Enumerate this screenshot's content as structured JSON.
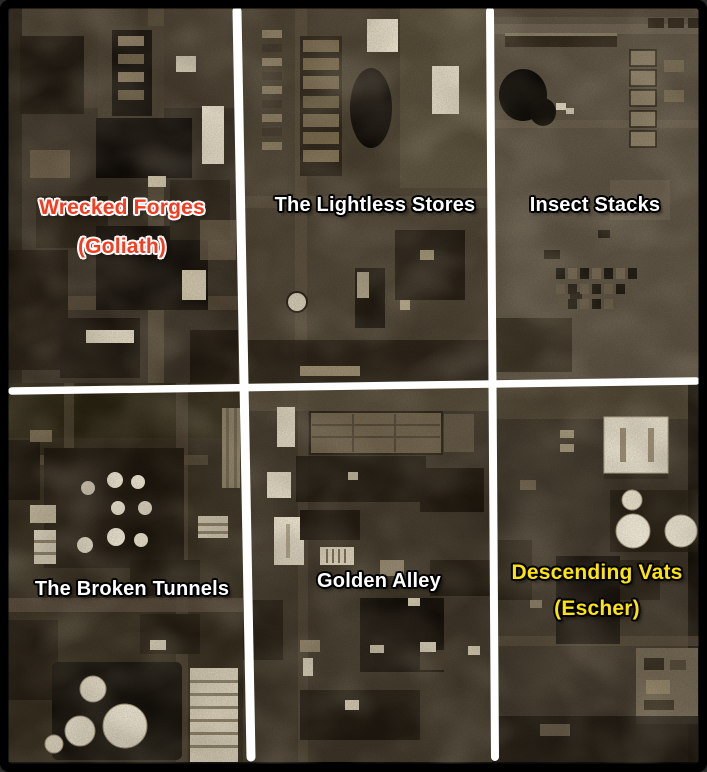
{
  "map": {
    "sectors": [
      {
        "name": "Wrecked Forges",
        "subtitle": "(Goliath)",
        "label_color": "#fa3a1e",
        "outline_color": "#ffffff"
      },
      {
        "name": "The Lightless Stores",
        "subtitle": "",
        "label_color": "#ffffff",
        "outline_color": "#000000"
      },
      {
        "name": "Insect Stacks",
        "subtitle": "",
        "label_color": "#ffffff",
        "outline_color": "#000000"
      },
      {
        "name": "The Broken Tunnels",
        "subtitle": "",
        "label_color": "#ffffff",
        "outline_color": "#000000"
      },
      {
        "name": "Golden Alley",
        "subtitle": "",
        "label_color": "#ffffff",
        "outline_color": "#000000"
      },
      {
        "name": "Descending Vats",
        "subtitle": "(Escher)",
        "label_color": "#ffe409",
        "outline_color": "#000000"
      }
    ],
    "divider_color": "#ffffff",
    "border_color": "#000000",
    "grid": {
      "rows": 2,
      "columns": 3
    }
  }
}
